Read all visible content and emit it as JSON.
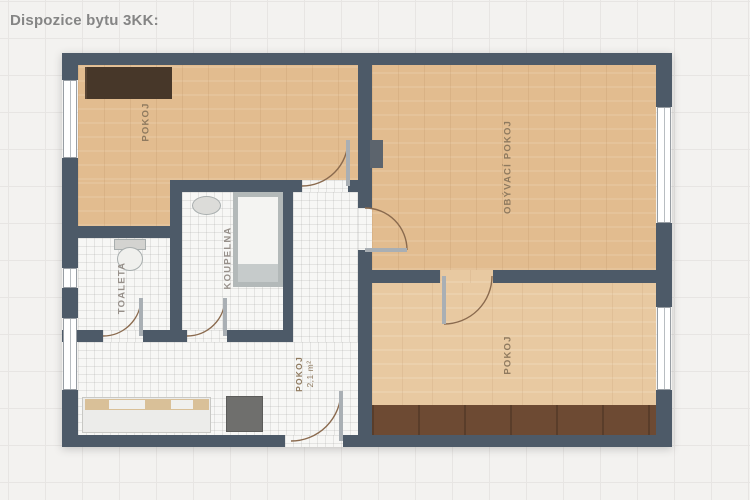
{
  "title": "Dispozice bytu 3KK:",
  "rooms": {
    "pokoj_top_left": {
      "label": "POKOJ"
    },
    "obyvaci_pokoj": {
      "label": "OBÝVACÍ POKOJ"
    },
    "pokoj_bottom": {
      "label": "POKOJ"
    },
    "koupelna": {
      "label": "KOUPELNA"
    },
    "toaleta": {
      "label": "TOALETA"
    },
    "hala": {
      "label": "POKOJ",
      "area": "2,1 m²"
    }
  },
  "colors": {
    "background": "#f3f2f0",
    "grid_line": "#e7e5e3",
    "wall": "#4d5a68",
    "wood_floor": "#e2bc8f",
    "wood_floor_light": "#e8c9a1",
    "tile_floor": "#f7f7f5",
    "wardrobe_brown": "#473729",
    "bed_strip_brown": "#6d4a33",
    "title_text": "#858585",
    "room_label_text": "#8f7a5f",
    "door_arc": "#8a6a4e"
  }
}
